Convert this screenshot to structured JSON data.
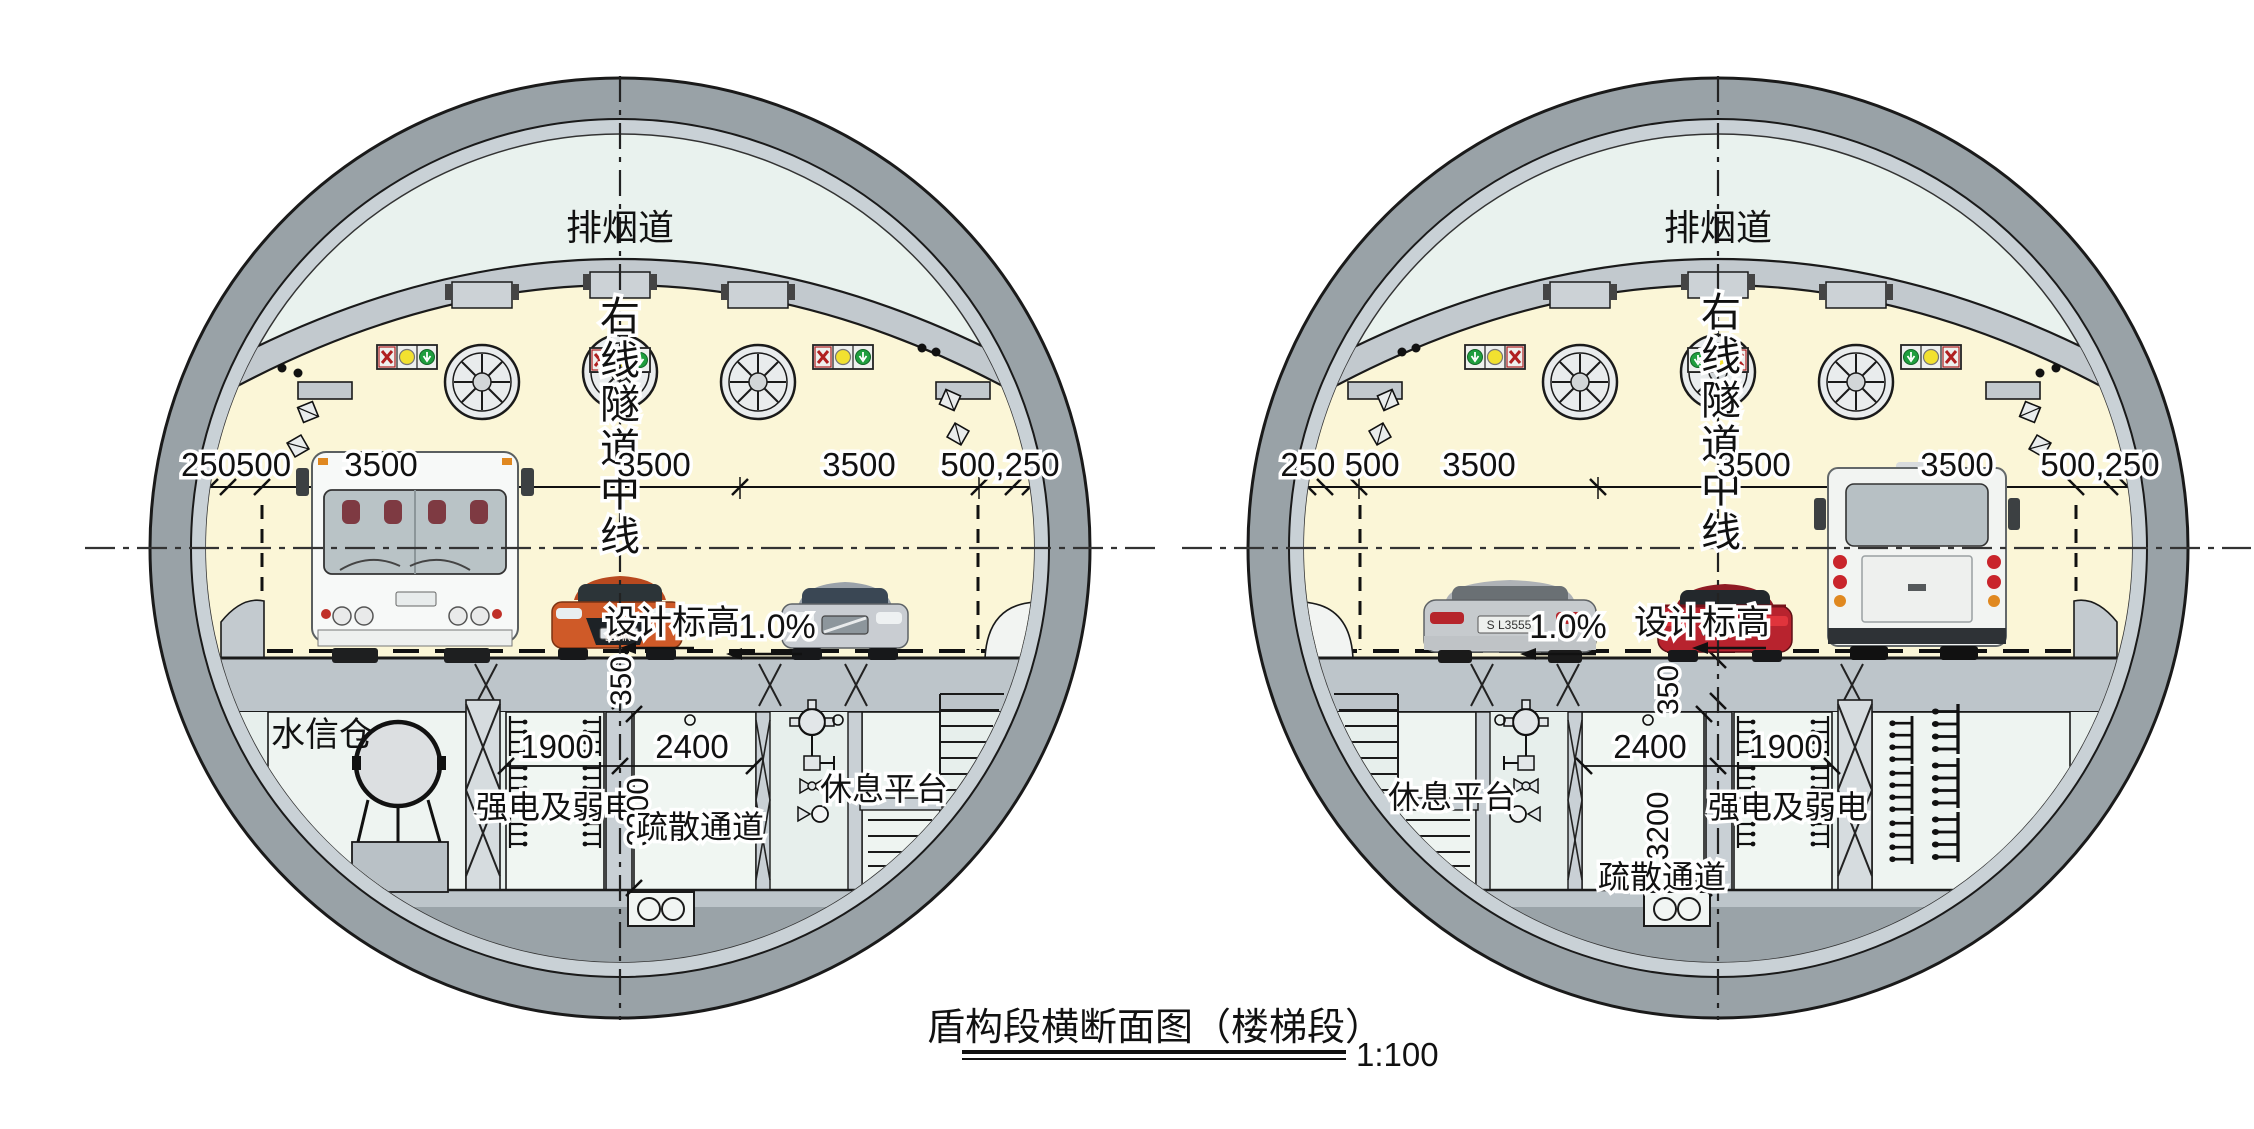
{
  "title": {
    "text": "盾构段横断面图（楼梯段）",
    "scale": "1:100"
  },
  "left": {
    "smoke_duct": "排烟道",
    "cl": [
      "右",
      "线",
      "隧",
      "道",
      "中",
      "线"
    ],
    "dim_left_edge": "250500",
    "dim_lane1": "3500",
    "dim_lane2": "3500",
    "dim_lane3": "3500",
    "dim_right_edge": "500,250",
    "design_elevation": "设计标高",
    "slope": "1.0%",
    "dim_350": "350",
    "water_room": "水信仓",
    "dim_1900": "1900",
    "dim_2400": "2400",
    "power_room": "强电及弱电",
    "dim_3200": "3200",
    "evac_passage": "疏散通道",
    "rest_platform": "休息平台",
    "levin_badge": "LEVIN"
  },
  "right": {
    "smoke_duct": "排烟道",
    "cl": [
      "右",
      "线",
      "隧",
      "道",
      "中",
      "线"
    ],
    "dim_left_edge": "250 500",
    "dim_lane1": "3500",
    "dim_lane2": "3500",
    "dim_lane3": "3500",
    "dim_right_edge": "500,250",
    "design_elevation": "设计标高",
    "slope": "1.0%",
    "dim_350": "350",
    "dim_1900": "1900",
    "dim_2400": "2400",
    "power_room": "强电及弱电",
    "dim_3200": "3200",
    "evac_passage": "疏散通道",
    "rest_platform": "休息平台",
    "mercedes_plate": "S L3555"
  }
}
